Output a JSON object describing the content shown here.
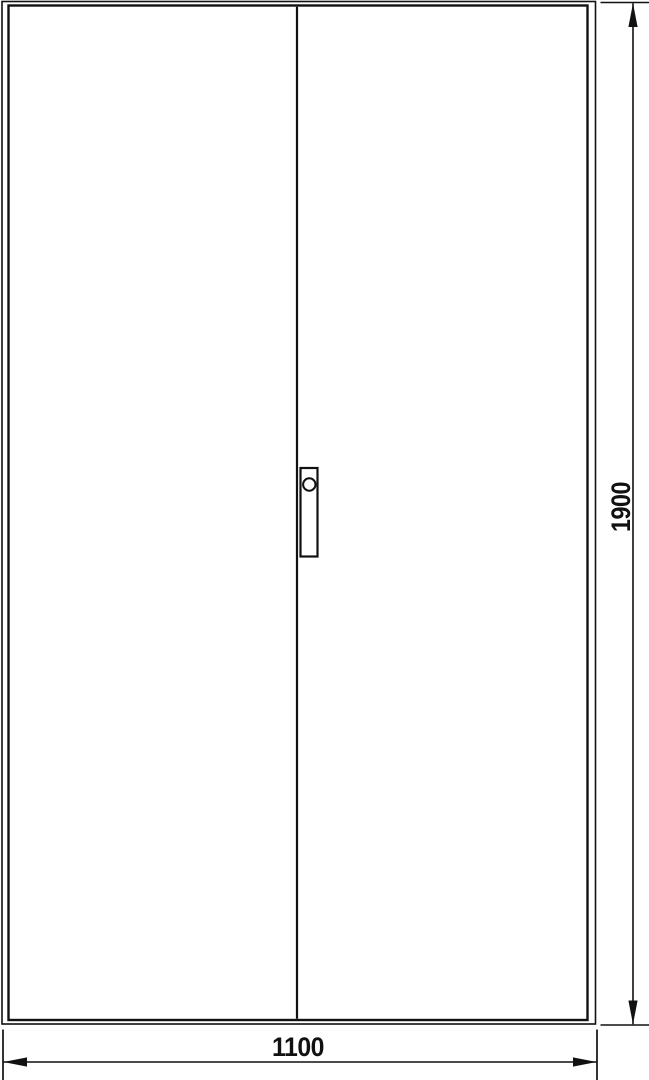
{
  "colors": {
    "line": "#111111",
    "background": "#ffffff"
  },
  "drawing": {
    "view": "two-door-cabinet-front-elevation",
    "door_count": 2,
    "dim_height": {
      "label": "1900"
    },
    "dim_width": {
      "label": "1100"
    }
  }
}
